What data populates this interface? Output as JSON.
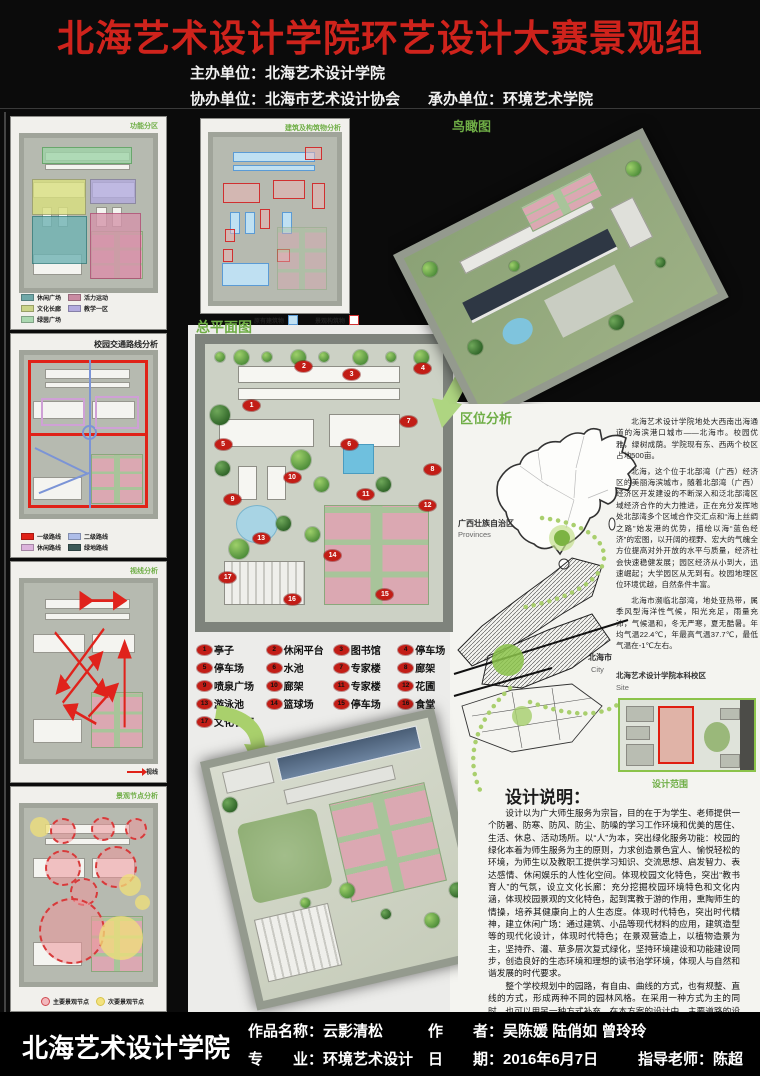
{
  "colors": {
    "title_red": "#cf231c",
    "accent_green": "#6fae46",
    "arrow_green": "#a9d06c",
    "marker_red": "#c21d16"
  },
  "header": {
    "title": "北海艺术设计学院环艺设计大赛景观组",
    "host": "主办单位：北海艺术设计学院",
    "co_host": "协办单位：北海市艺术设计协会",
    "undertaker": "承办单位：环境艺术学院"
  },
  "left_panels": [
    {
      "title": "功能分区",
      "legend": [
        {
          "label": "休闲广场",
          "css": "background:#6fa8a8"
        },
        {
          "label": "活力运动",
          "css": "background:#c98ba2"
        },
        {
          "label": "文化长廊",
          "css": "background:#cbd489"
        },
        {
          "label": "教学一区",
          "css": "background:#b3abdf"
        },
        {
          "label": "绿茵广场",
          "css": "background:#abd8b0"
        }
      ]
    },
    {
      "title": "校园交通路线分析",
      "legend": [
        {
          "label": "一级路线",
          "css": "background:#e02218"
        },
        {
          "label": "二级路线",
          "css": "background:#aebde8"
        },
        {
          "label": "休闲路线",
          "css": "background:#dcb3dc"
        },
        {
          "label": "绿地路线",
          "css": "background:#3d5a58"
        }
      ]
    },
    {
      "title": "视线分析",
      "legend": [
        {
          "label": "视线",
          "css": "background:#e02218"
        }
      ]
    },
    {
      "title": "景观节点分析",
      "legend": [
        {
          "label": "主要景观节点",
          "css": "background:#f2b8bc;border-radius:50%;border:1px solid #d04a50"
        },
        {
          "label": "次要景观节点",
          "css": "background:#f3e27e;border-radius:50%;border:1px solid #d8c44a"
        }
      ]
    }
  ],
  "middle": {
    "analysis_title": "建筑及构筑物分析",
    "master_plan_label": "总平面图",
    "plan_legend": [
      {
        "label": "原有建筑物",
        "css": "background:#bfe0f2;border:1px solid #5b9bd5"
      },
      {
        "label": "景观构筑物",
        "css": "background:#fff;border:1px solid #d03030"
      }
    ],
    "aerial_label": "鸟瞰图",
    "numbered_legend": [
      {
        "num": "1",
        "label": "亭子"
      },
      {
        "num": "2",
        "label": "休闲平台"
      },
      {
        "num": "3",
        "label": "图书馆"
      },
      {
        "num": "4",
        "label": "停车场"
      },
      {
        "num": "5",
        "label": "停车场"
      },
      {
        "num": "6",
        "label": "水池"
      },
      {
        "num": "7",
        "label": "专家楼"
      },
      {
        "num": "8",
        "label": "廊架"
      },
      {
        "num": "9",
        "label": "喷泉广场"
      },
      {
        "num": "10",
        "label": "廊架"
      },
      {
        "num": "11",
        "label": "专家楼"
      },
      {
        "num": "12",
        "label": "花圃"
      },
      {
        "num": "13",
        "label": "游泳池"
      },
      {
        "num": "14",
        "label": "篮球场"
      },
      {
        "num": "15",
        "label": "停车场"
      },
      {
        "num": "16",
        "label": "食堂"
      },
      {
        "num": "17",
        "label": "文化长廊"
      }
    ]
  },
  "right": {
    "aerial_label": "鸟瞰图",
    "location": {
      "title": "区位分析",
      "province_label": "广西壮族自治区",
      "province_sub": "Provinces",
      "city_label": "北海市",
      "city_sub": "City",
      "site_label": "北海艺术设计学院本科校区",
      "site_sub": "Site",
      "scope_label": "设计范围",
      "paragraphs": [
        "北海艺术设计学院地处大西南出海通道的海滨港口城市——北海市。校园优雅，绿树成荫。学院现有东、西两个校区占地500亩。",
        "北海，这个位于北部湾（广西）经济区的美丽海滨城市，随着北部湾（广西）经济区开发建设的不断深入和泛北部湾区域经济合作的大力推进，正在充分发挥地处北部湾多个区域合作交汇点和“海上丝绸之路”始发港的优势，描绘以海“蓝色经济”的宏图，以开阔的视野、宏大的气魄全方位提高对外开放的水平与质量，经济社会快速稳健发展；园区经济从小到大，迅速崛起；大学园区从无到有。校园地理区位环境优越，自然条件丰富。",
        "北海市濒临北部湾，地处亚热带，属季风型海洋性气候，阳光充足，雨量充沛，气候温和，冬无严寒，夏无酷暑。年均气温22.4℃，年最高气温37.7℃，最低气温在-1℃左右。"
      ]
    },
    "description": {
      "title": "设计说明：",
      "paragraphs": [
        "设计以为广大师生服务为宗旨，目的在于为学生、老师提供一个防暑、防寒、防风、防尘、防噪的学习工作环境和优美的居住、生活、休息、活动场所。以“人”为本，突出绿化服务功能：校园的绿化本着为师生服务为主的原则，力求创造景色宜人、愉悦轻松的环境，为师生以及教职工提供学习知识、交流思想、启发智力、表达感情、休闲娱乐的人性化空间。体现校园文化特色，突出“教书育人”的气氛，设立文化长廊：充分挖掘校园环境特色和文化内涵，体现校园景观的文化特色，起到寓教于游的作用，熏陶师生的情操，培养其健康向上的人生态度。体现时代特色，突出时代精神，建立休闲广场：通过建筑、小品等现代材料的应用，建筑造型等的现代化设计，体现时代特色；在景观营造上，以植物造景为主，坚持乔、灌、草多层次复式绿化，坚持环境建设和功能建设同步，创造良好的生态环境和理想的读书治学环境，体现人与自然和谐发展的时代要求。",
        "整个学校规划中的园路，有自由、曲线的方式，也有规整、直线的方式，形成两种不同的园林风格。在采用一种方式为主的同时，也可以用另一种方式补充。在本方案的设计中，主要道路的设计为线形规整式道路，而所有园路均采用了自然式，园路的线型设计以方便游人游览整个游区为主，同时也满足学生们晨读和休息时的使用。道路绿化以遮荫为主，行道树主要选用榕树、槐树等。"
      ]
    }
  },
  "footer": {
    "school": "北海艺术设计学院",
    "fields": [
      {
        "label": "作品名称：",
        "value": "云影清松"
      },
      {
        "label": "专　　业：",
        "value": "环境艺术设计"
      },
      {
        "label": "作　　者：",
        "value": "吴陈媛 陆俏如 曾玲玲"
      },
      {
        "label": "日　　期：",
        "value": "2016年6月7日"
      },
      {
        "label": "指导老师：",
        "value": "陈超"
      }
    ]
  }
}
